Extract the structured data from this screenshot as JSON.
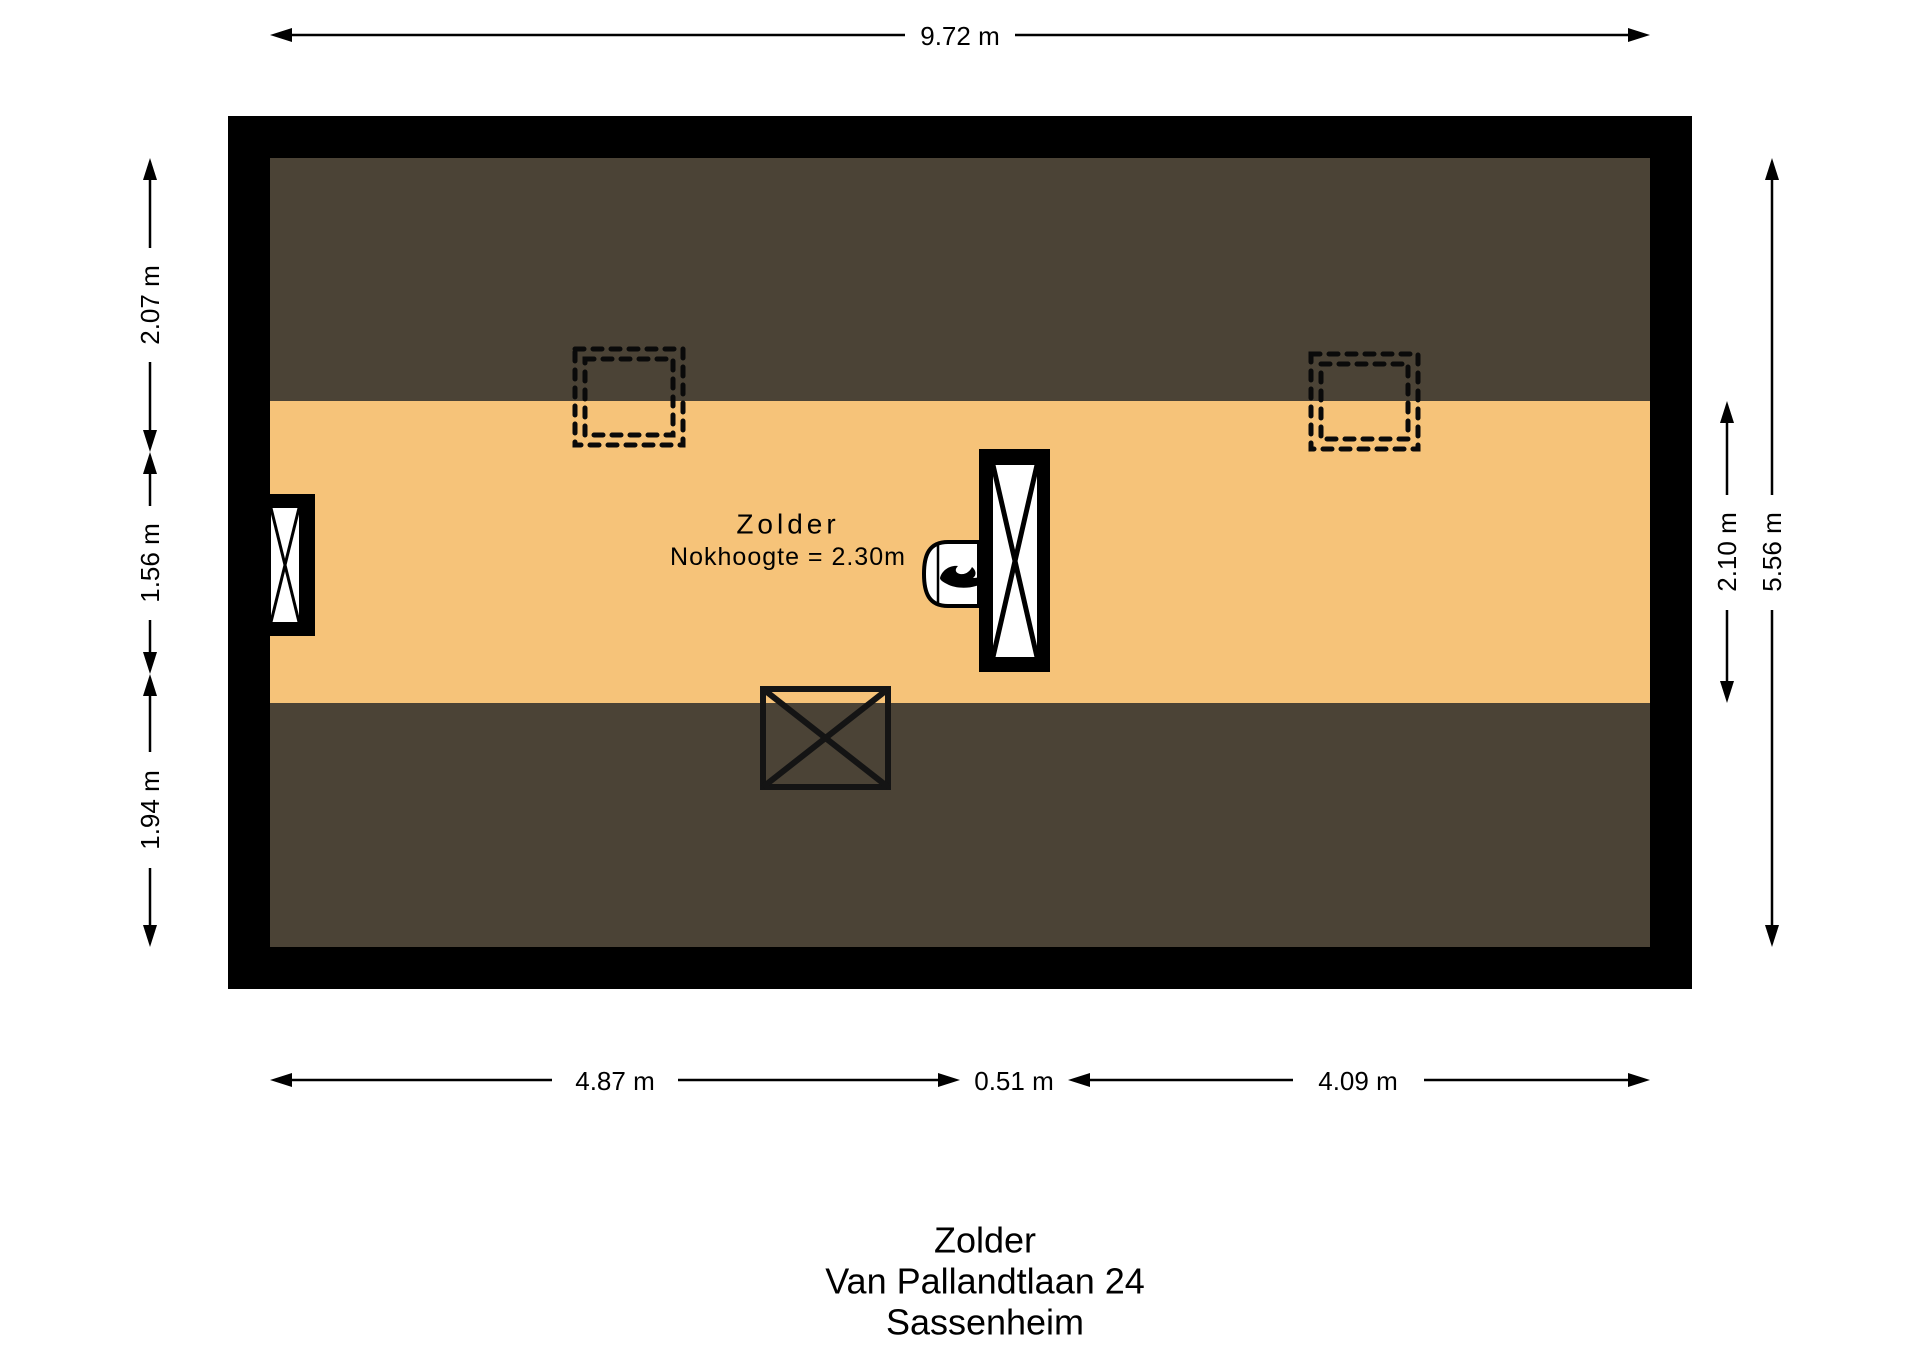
{
  "plan": {
    "room": {
      "label": "Zolder",
      "ridge_height_note": "Nokhoogte = 2.30m"
    },
    "dimensions": {
      "width_top": "9.72 m",
      "bottom_segments": [
        "4.87 m",
        "0.51 m",
        "4.09 m"
      ],
      "left_segments": [
        "2.07 m",
        "1.56 m",
        "1.94 m"
      ],
      "right_band": "2.10 m",
      "right_total": "5.56 m"
    },
    "colors": {
      "wall": "#000000",
      "roof_slope_area": "#4b4336",
      "floor_area": "#f6c379",
      "dimension_line": "#000000",
      "background": "#ffffff"
    },
    "features": [
      {
        "name": "skylight-left",
        "symbol": "double-dashed-square"
      },
      {
        "name": "skylight-right",
        "symbol": "double-dashed-square"
      },
      {
        "name": "window-left",
        "symbol": "window-cross"
      },
      {
        "name": "chimney-shaft",
        "symbol": "crossed-shaft"
      },
      {
        "name": "boiler",
        "symbol": "cylinder-with-flame",
        "icon": "flame-icon"
      },
      {
        "name": "floor-opening",
        "symbol": "crossed-box"
      }
    ]
  },
  "title_block": {
    "room": "Zolder",
    "address": "Van Pallandtlaan 24",
    "city": "Sassenheim"
  }
}
